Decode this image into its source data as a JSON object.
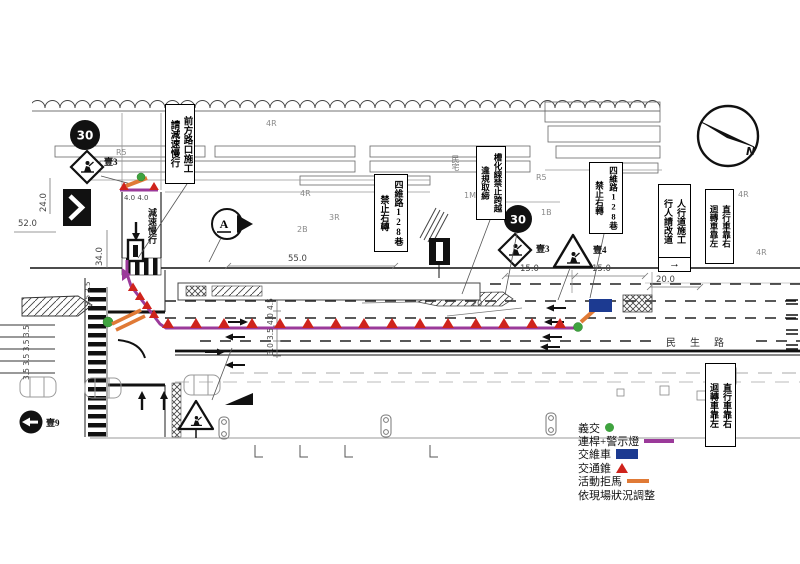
{
  "signs": {
    "front_construction": {
      "right": "前方路口施工",
      "left": "請減速慢行"
    },
    "no_right_turn_a": {
      "right": "四維路128巷",
      "left": "禁止右轉"
    },
    "channelization": {
      "right": "槽化線禁止跨越",
      "left": "違規取締"
    },
    "no_right_turn_b": {
      "right": "四維路128巷",
      "left": "禁止右轉"
    },
    "sidewalk_works": {
      "right": "人行道施工",
      "left": "行人請改道",
      "arrow": "→"
    },
    "keep_right_a": {
      "right": "直行車靠右",
      "left": "迴轉車靠左"
    },
    "keep_right_b": {
      "right": "直行車靠右",
      "left": "迴轉車靠左"
    },
    "speed_limit": "30",
    "detour_route": "A",
    "slow_down": "減速慢行"
  },
  "labels": {
    "unit_diamond_a": "壹3",
    "unit_diamond_b": "壹3",
    "unit_triangle": "壹4",
    "unit_oneway": "壹9",
    "street_name": "民生路",
    "house": "民宅",
    "north": "N"
  },
  "building_labels": [
    "4R",
    "R5",
    "4R",
    "3R",
    "2B",
    "1M",
    "R5",
    "1B",
    "4R",
    "4R"
  ],
  "dimensions": {
    "d52": "52.0",
    "d24": "24.0",
    "d34": "34.0",
    "d55": "55.0",
    "d15a": "15.0",
    "d15b": "15.0",
    "d20w": "20.0",
    "d20c": "20",
    "lane_widths": [
      "4.5",
      "4.0",
      "3.5",
      "3.0"
    ],
    "w44": "4.0 4.0",
    "w35a": "3.5 3.5 3.5 3.5",
    "w35b": "3.5 3.5"
  },
  "legend": {
    "rows": [
      {
        "label": "義交",
        "swatch": "green-dot"
      },
      {
        "label": "連桿+警示燈",
        "swatch": "purple-line"
      },
      {
        "label": "交維車",
        "swatch": "blue-rect"
      },
      {
        "label": "交通錐",
        "swatch": "red-triangle"
      },
      {
        "label": "活動拒馬",
        "swatch": "orange-line"
      },
      {
        "label": "依現場狀況調整",
        "swatch": "none"
      }
    ]
  },
  "colors": {
    "route_purple": "#9b3a9a",
    "cone_red": "#cf231c",
    "guard_green": "#3fa33f",
    "vehicle_blue": "#1c3a91",
    "barricade_orange": "#e07a36"
  }
}
